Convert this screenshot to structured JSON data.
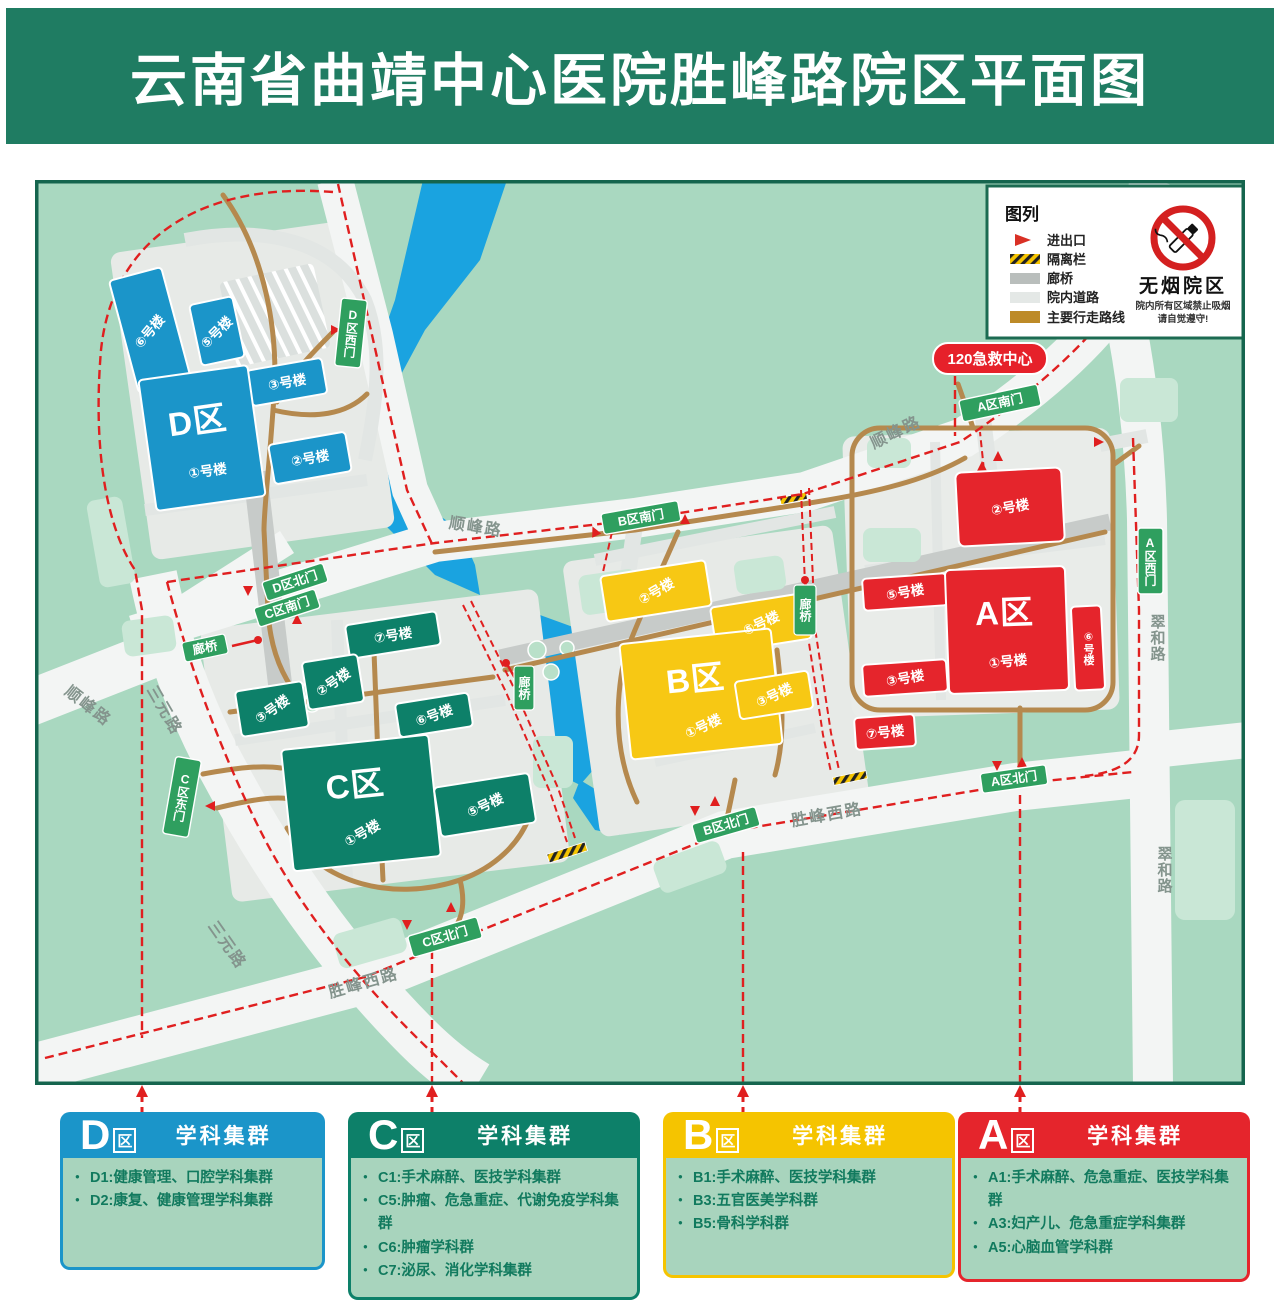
{
  "title": "云南省曲靖中心医院胜峰路院区平面图",
  "colors": {
    "banner_green": "#1f7c62",
    "zone_d_blue": "#1b95c9",
    "zone_c_green": "#0d8069",
    "zone_b_yellow": "#f7c814",
    "zone_a_red": "#e5252c",
    "gate_green": "#2f9f5f",
    "route_red": "#e01f1f",
    "walk_route_brown": "#b5894e",
    "river_blue": "#1aa3e0"
  },
  "legend": {
    "title": "图列",
    "items": [
      {
        "label": "进出口"
      },
      {
        "label": "隔离栏"
      },
      {
        "label": "廊桥"
      },
      {
        "label": "院内道路"
      },
      {
        "label": "主要行走路线"
      }
    ],
    "no_smoking": {
      "title": "无烟院区",
      "line1": "院内所有区域禁止吸烟",
      "line2": "请自觉遵守!"
    }
  },
  "map": {
    "emergency": "120急救中心",
    "bridge": "廊桥",
    "roads": {
      "shunfeng": "顺峰路",
      "sanyuan": "三元路",
      "shengfeng_west": "胜峰西路",
      "cuihe": "翠和路"
    },
    "gates": {
      "d_west": "D区西门",
      "d_north": "D区北门",
      "c_south": "C区南门",
      "c_east": "C区东门",
      "c_north": "C区北门",
      "b_south": "B区南门",
      "b_north": "B区北门",
      "a_south": "A区南门",
      "a_west": "A区西门",
      "a_north": "A区北门"
    },
    "zones": {
      "d": {
        "label": "D区",
        "b1": "①号楼",
        "b2": "②号楼",
        "b3": "③号楼",
        "b5": "⑤号楼",
        "b6": "⑥号楼"
      },
      "c": {
        "label": "C区",
        "b1": "①号楼",
        "b2": "②号楼",
        "b3": "③号楼",
        "b5": "⑤号楼",
        "b6": "⑥号楼",
        "b7": "⑦号楼"
      },
      "b": {
        "label": "B区",
        "b1": "①号楼",
        "b2": "②号楼",
        "b3": "③号楼",
        "b5": "⑤号楼"
      },
      "a": {
        "label": "A区",
        "b1": "①号楼",
        "b2": "②号楼",
        "b3": "③号楼",
        "b5": "⑤号楼",
        "b6": "⑥号楼",
        "b7": "⑦号楼"
      }
    }
  },
  "panels": [
    {
      "letter": "D",
      "suffix": "区",
      "title": "学科集群",
      "color": "#1b95c9",
      "items": [
        "D1:健康管理、口腔学科集群",
        "D2:康复、健康管理学科集群"
      ]
    },
    {
      "letter": "C",
      "suffix": "区",
      "title": "学科集群",
      "color": "#0d8069",
      "items": [
        "C1:手术麻醉、医技学科集群",
        "C5:肿瘤、危急重症、代谢免疫学科集群",
        "C6:肿瘤学科群",
        "C7:泌尿、消化学科集群"
      ]
    },
    {
      "letter": "B",
      "suffix": "区",
      "title": "学科集群",
      "color": "#f5c400",
      "items": [
        "B1:手术麻醉、医技学科集群",
        "B3:五官医美学科群",
        "B5:骨科学科群"
      ]
    },
    {
      "letter": "A",
      "suffix": "区",
      "title": "学科集群",
      "color": "#e5252c",
      "items": [
        "A1:手术麻醉、危急重症、医技学科集群",
        "A3:妇产儿、危急重症学科集群",
        "A5:心脑血管学科群"
      ]
    }
  ]
}
